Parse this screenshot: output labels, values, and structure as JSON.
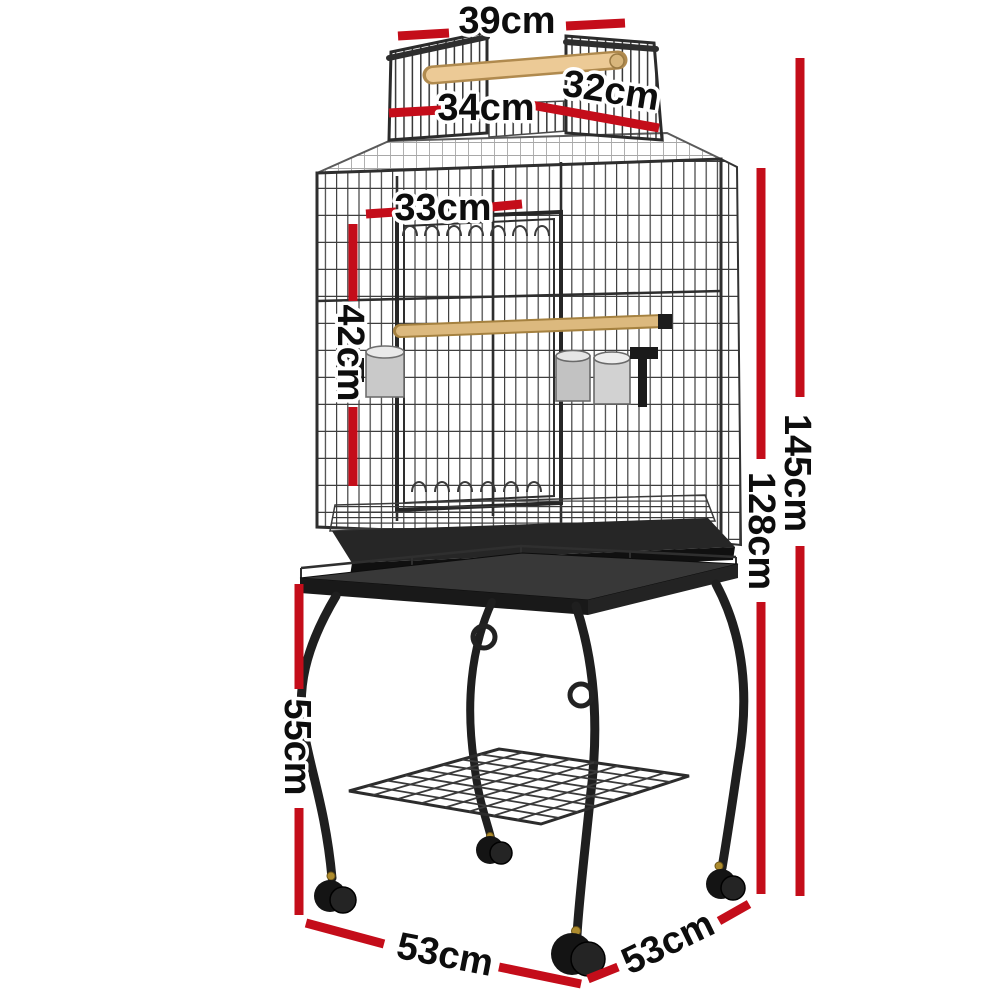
{
  "image_type": "product-dimension-diagram",
  "subject": "bird cage with open play top on wheeled stand",
  "colors": {
    "background": "#ffffff",
    "dimension_red": "#c40d1a",
    "label_text": "#0d0d0d",
    "cage_metal": "#2e2e2e",
    "wood_perch": "#ecca96",
    "steel_bowl": "#d6d6d6"
  },
  "measurements": {
    "top_handle_width": "39cm",
    "left_roof_door": "34cm",
    "right_roof_door": "32cm",
    "front_door_width": "33cm",
    "upper_section_height": "42cm",
    "total_height": "145cm",
    "cage_height": "128cm",
    "stand_height": "55cm",
    "base_side_left": "53cm",
    "base_side_right": "53cm"
  }
}
